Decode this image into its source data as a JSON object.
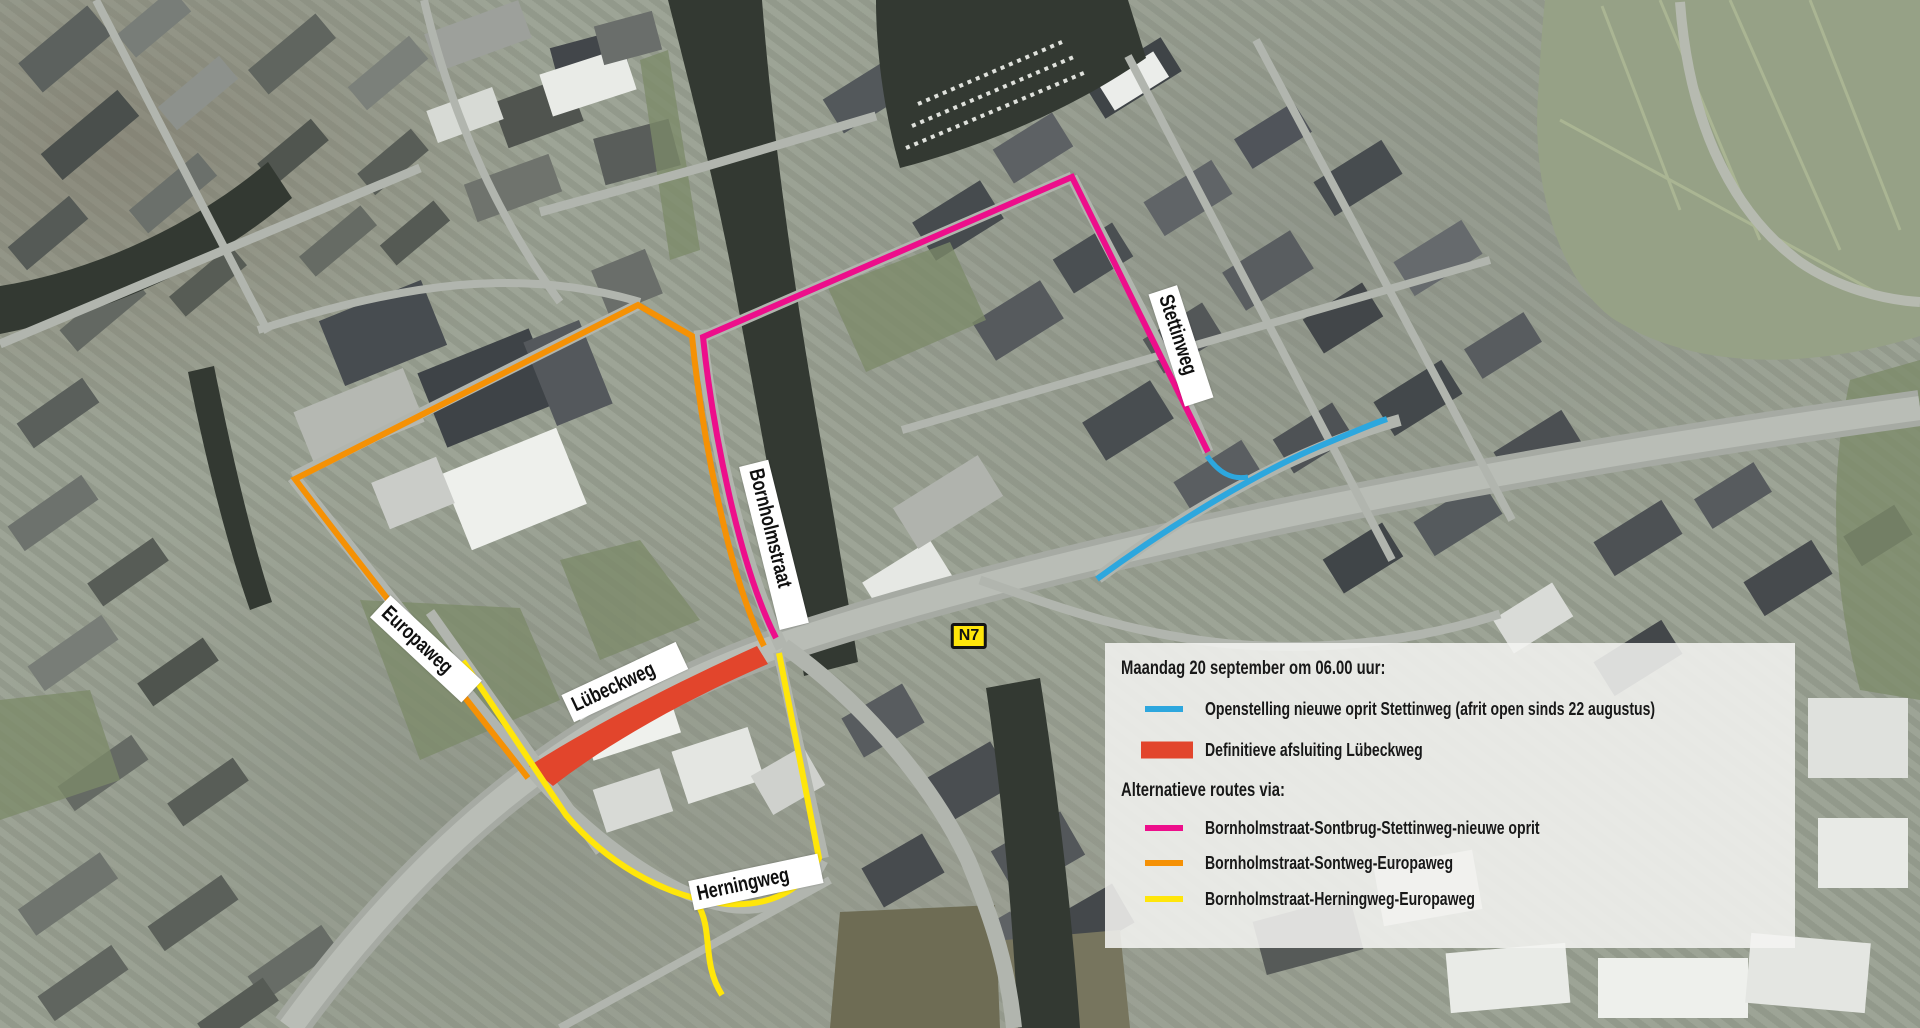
{
  "map": {
    "badge_n7": "N7",
    "street_labels": [
      {
        "name": "Stettinweg"
      },
      {
        "name": "Bornholmstraat"
      },
      {
        "name": "Europaweg"
      },
      {
        "name": "Lübeckweg"
      },
      {
        "name": "Herningweg"
      }
    ],
    "route_colors": {
      "new_onramp_blue": "#2da7de",
      "closure_red": "#e2452c",
      "route_magenta": "#ed0e8b",
      "route_orange": "#f59105",
      "route_yellow": "#ffe60a"
    }
  },
  "legend": {
    "section1_title": "Maandag 20 september om 06.00 uur:",
    "section1_items": [
      {
        "label": "Openstelling nieuwe oprit Stettinweg (afrit open sinds 22 augustus)",
        "color": "#2da7de",
        "swatch": "line"
      },
      {
        "label": "Definitieve afsluiting Lübeckweg",
        "color": "#e2452c",
        "swatch": "block"
      }
    ],
    "section2_title": "Alternatieve routes via:",
    "section2_items": [
      {
        "label": "Bornholmstraat-Sontbrug-Stettinweg-nieuwe oprit",
        "color": "#ed0e8b"
      },
      {
        "label": "Bornholmstraat-Sontweg-Europaweg",
        "color": "#f59105"
      },
      {
        "label": "Bornholmstraat-Herningweg-Europaweg",
        "color": "#ffe60a"
      }
    ]
  }
}
